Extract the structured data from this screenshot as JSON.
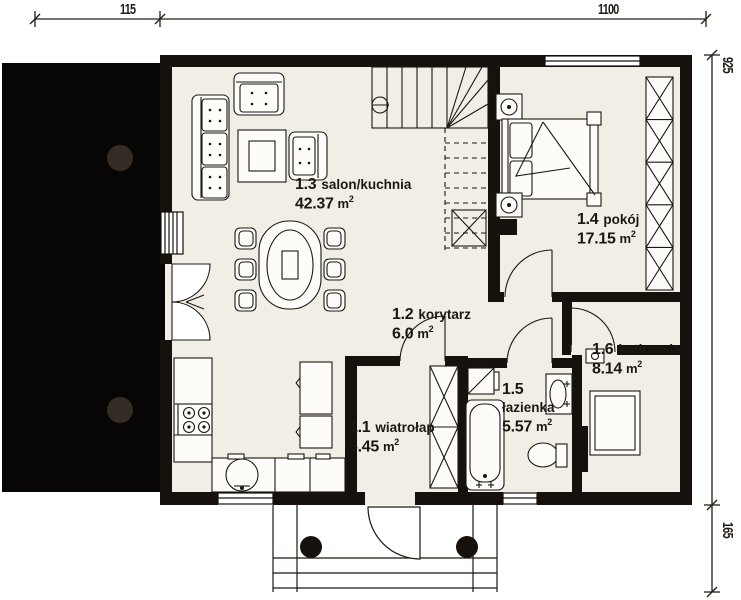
{
  "title": "floor-plan",
  "colors": {
    "wall": "#16110d",
    "floor": "#f1eee6",
    "terrace": "#070604",
    "column": "#332d26",
    "background": "#ffffff",
    "text": "#1c1712"
  },
  "dimensions": {
    "top_left": "115",
    "top_right": "1100",
    "right_top": "925",
    "right_bottom": "165"
  },
  "rooms": [
    {
      "id": "1.1",
      "name": "wiatrołap",
      "area": "6.45",
      "unit": "m",
      "sup": "2"
    },
    {
      "id": "1.2",
      "name": "korytarz",
      "area": "6.0",
      "unit": "m",
      "sup": "2"
    },
    {
      "id": "1.3",
      "name": "salon/kuchnia",
      "area": "42.37",
      "unit": "m",
      "sup": "2"
    },
    {
      "id": "1.4",
      "name": "pokój",
      "area": "17.15",
      "unit": "m",
      "sup": "2"
    },
    {
      "id": "1.5",
      "name": "łazienka",
      "area": "5.57",
      "unit": "m",
      "sup": "2"
    },
    {
      "id": "1.6",
      "name": "kotłownia",
      "area": "8.14",
      "unit": "m",
      "sup": "2"
    }
  ],
  "symbols": [
    "sofa-icon",
    "armchair-icon",
    "coffee-table-icon",
    "dining-table-icon",
    "chair-icon",
    "kitchen-counter-icon",
    "stove-icon",
    "sink-icon",
    "fridge-icon",
    "staircase-icon",
    "double-bed-icon",
    "nightstand-lamp-icon",
    "wardrobe-icon",
    "bathtub-icon",
    "washbasin-icon",
    "toilet-icon",
    "boiler-icon",
    "radiator-icon",
    "entrance-steps-icon",
    "terrace-column-icon",
    "door-swing-icon"
  ]
}
